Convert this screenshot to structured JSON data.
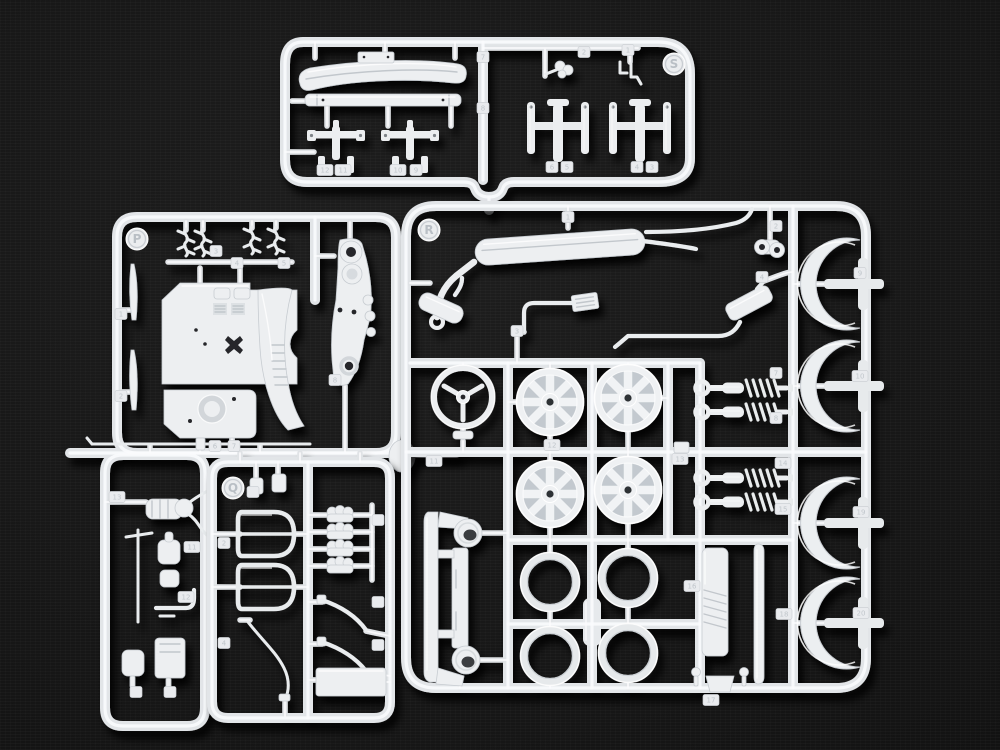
{
  "scene": {
    "description": "Overhead photograph of four white injection-molded plastic model-car sprues (parts trees) lettered P, Q, R and S, lying on a black fabric background",
    "background_color": "#121212",
    "plastic_color": "#edeff1",
    "shadow_color": "#000000"
  },
  "sprues": {
    "S": {
      "label": "S",
      "position": "top",
      "contents": [
        "front bumper",
        "rear bumper bar",
        "license plate bracket",
        "bumper guard clips",
        "seat frame brackets",
        "four bumper stay channels"
      ],
      "part_number_tabs": [
        {
          "n": "7",
          "x": 483,
          "y": 57
        },
        {
          "n": "8",
          "x": 483,
          "y": 108
        },
        {
          "n": "2",
          "x": 584,
          "y": 52
        },
        {
          "n": "1",
          "x": 628,
          "y": 50
        },
        {
          "n": "12",
          "x": 325,
          "y": 170
        },
        {
          "n": "11",
          "x": 343,
          "y": 170
        },
        {
          "n": "10",
          "x": 398,
          "y": 170
        },
        {
          "n": "9",
          "x": 416,
          "y": 170
        },
        {
          "n": "6",
          "x": 552,
          "y": 167
        },
        {
          "n": "5",
          "x": 567,
          "y": 167
        },
        {
          "n": "4",
          "x": 637,
          "y": 167
        },
        {
          "n": "3",
          "x": 652,
          "y": 167
        }
      ]
    },
    "P": {
      "label": "P",
      "position": "left",
      "contents": [
        "firewall / bulkhead panel",
        "fuel tank panel",
        "curved sill panel",
        "suspension upright",
        "wire spring clips",
        "thin blades",
        "long linkage rod",
        "air-cleaner oval",
        "distributor with wires",
        "carburetor bodies",
        "elbow pipe",
        "door mirrors"
      ],
      "part_number_tabs": [
        {
          "n": "3",
          "x": 216,
          "y": 251
        },
        {
          "n": "4",
          "x": 237,
          "y": 263
        },
        {
          "n": "5",
          "x": 284,
          "y": 263
        },
        {
          "n": "1",
          "x": 121,
          "y": 314
        },
        {
          "n": "2",
          "x": 121,
          "y": 396
        },
        {
          "n": "6",
          "x": 215,
          "y": 446
        },
        {
          "n": "7",
          "x": 234,
          "y": 446
        },
        {
          "n": "8",
          "x": 335,
          "y": 380
        },
        {
          "n": "11",
          "x": 192,
          "y": 547
        },
        {
          "n": "12",
          "x": 186,
          "y": 597
        },
        {
          "n": "13",
          "x": 117,
          "y": 497
        },
        {
          "n": "",
          "x": 136,
          "y": 692
        },
        {
          "n": "",
          "x": 170,
          "y": 692
        }
      ]
    },
    "Q": {
      "label": "Q",
      "position": "bottom-center-left",
      "contents": [
        "pedal brackets",
        "door window frames",
        "curved wire rod",
        "carburetor velocity stacks",
        "curved levers",
        "flat base panel"
      ],
      "part_number_tabs": [
        {
          "n": "2",
          "x": 224,
          "y": 543
        },
        {
          "n": "4",
          "x": 224,
          "y": 643
        },
        {
          "n": "",
          "x": 253,
          "y": 492
        },
        {
          "n": "",
          "x": 378,
          "y": 520
        },
        {
          "n": "",
          "x": 378,
          "y": 602
        },
        {
          "n": "",
          "x": 378,
          "y": 645
        }
      ]
    },
    "R": {
      "label": "R",
      "position": "right",
      "contents": [
        "full exhaust with main muffler",
        "resonator",
        "front pipe with heat shield",
        "rear pipe with angled muffler",
        "two-hole flange",
        "steering wheel",
        "four 8-spoke wheels",
        "four wheel trim rings",
        "four coil-over shock absorbers",
        "four fender arch flares",
        "front valance with headlight pods",
        "radiator panel",
        "trim strip",
        "ball pins and bracket"
      ],
      "part_number_tabs": [
        {
          "n": "1",
          "x": 568,
          "y": 217
        },
        {
          "n": "2",
          "x": 776,
          "y": 226
        },
        {
          "n": "3",
          "x": 517,
          "y": 331
        },
        {
          "n": "4",
          "x": 762,
          "y": 277
        },
        {
          "n": "7",
          "x": 776,
          "y": 373
        },
        {
          "n": "8",
          "x": 776,
          "y": 418
        },
        {
          "n": "9",
          "x": 860,
          "y": 273
        },
        {
          "n": "10",
          "x": 860,
          "y": 376
        },
        {
          "n": "11",
          "x": 434,
          "y": 461
        },
        {
          "n": "12",
          "x": 552,
          "y": 445
        },
        {
          "n": "13",
          "x": 680,
          "y": 459
        },
        {
          "n": "14",
          "x": 783,
          "y": 463
        },
        {
          "n": "15",
          "x": 783,
          "y": 509
        },
        {
          "n": "16",
          "x": 692,
          "y": 586
        },
        {
          "n": "17",
          "x": 711,
          "y": 700
        },
        {
          "n": "18",
          "x": 784,
          "y": 614
        },
        {
          "n": "19",
          "x": 861,
          "y": 512
        },
        {
          "n": "20",
          "x": 861,
          "y": 613
        }
      ]
    }
  },
  "molded_labels": [
    {
      "text": "P",
      "x": 137,
      "y": 239
    },
    {
      "text": "Q",
      "x": 233,
      "y": 488
    },
    {
      "text": "R",
      "x": 429,
      "y": 230
    },
    {
      "text": "S",
      "x": 674,
      "y": 64
    }
  ]
}
